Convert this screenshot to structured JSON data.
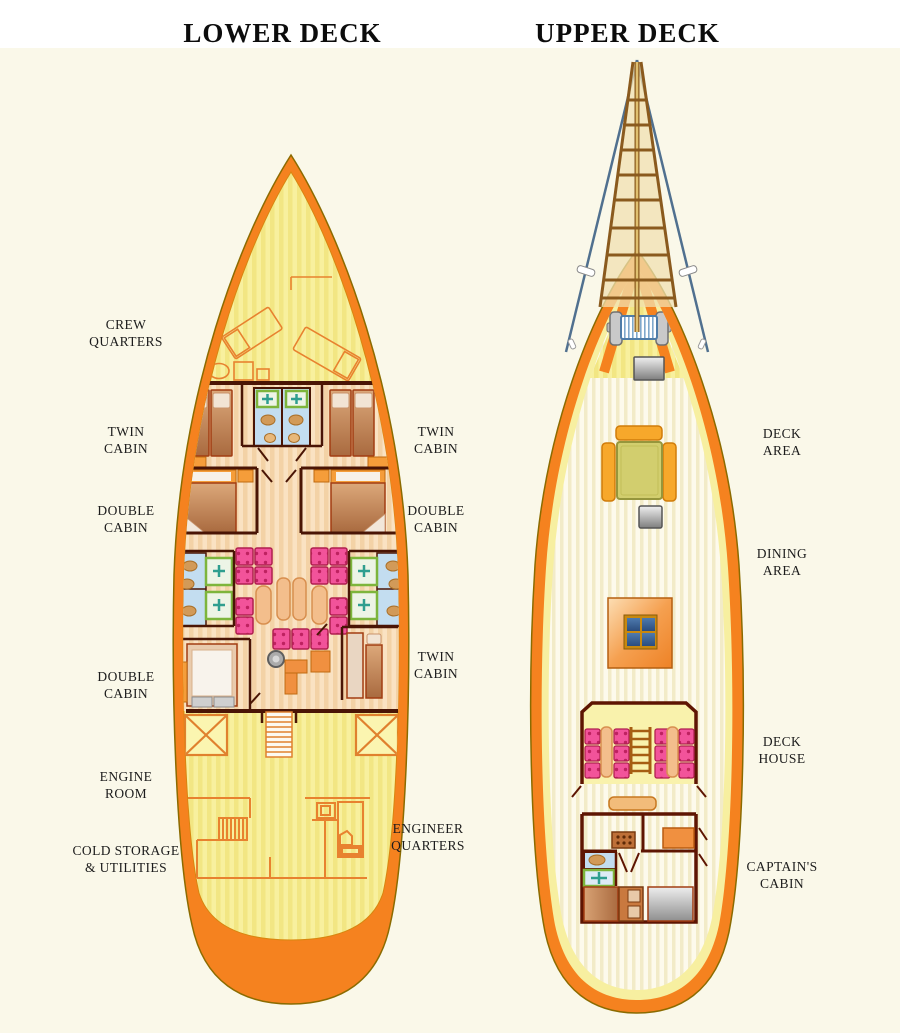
{
  "titles": {
    "lower": "LOWER DECK",
    "upper": "UPPER DECK"
  },
  "lower_deck": {
    "labels_left": [
      {
        "lines": [
          "CREW",
          "QUARTERS"
        ]
      },
      {
        "lines": [
          "TWIN",
          "CABIN"
        ]
      },
      {
        "lines": [
          "DOUBLE",
          "CABIN"
        ]
      },
      {
        "lines": [
          "DOUBLE",
          "CABIN"
        ]
      },
      {
        "lines": [
          "ENGINE",
          "ROOM"
        ]
      },
      {
        "lines": [
          "COLD STORAGE",
          "& UTILITIES"
        ]
      }
    ],
    "labels_right": [
      {
        "lines": [
          "TWIN",
          "CABIN"
        ]
      },
      {
        "lines": [
          "DOUBLE",
          "CABIN"
        ]
      },
      {
        "lines": [
          "TWIN",
          "CABIN"
        ]
      },
      {
        "lines": [
          "ENGINEER",
          "QUARTERS"
        ]
      }
    ]
  },
  "upper_deck": {
    "labels_right": [
      {
        "lines": [
          "DECK",
          "AREA"
        ]
      },
      {
        "lines": [
          "DINING",
          "AREA"
        ]
      },
      {
        "lines": [
          "DECK",
          "HOUSE"
        ]
      },
      {
        "lines": [
          "CAPTAIN'S",
          "CABIN"
        ]
      }
    ]
  },
  "features": {
    "upper": [
      "bowsprit-ladder",
      "rigging-stays",
      "anchor-windlass",
      "deck-hatch",
      "dining-table",
      "bench-seating",
      "skylight-window",
      "companionway-ladder",
      "galley-counter",
      "captain-bed",
      "berth",
      "bathroom"
    ],
    "lower": [
      "crew-beds",
      "twin-beds",
      "double-beds",
      "bathrooms",
      "salon-seating",
      "galley-table",
      "engine-hatches",
      "staircase",
      "storage-rooms"
    ]
  },
  "colors": {
    "hull_orange": "#F5821F",
    "deck_yellow": "#F8F09E",
    "cabin_floor": "#FAE2C2",
    "wall_dark": "#4A1505",
    "wood_outline": "#E8822F",
    "seat_pink": "#F2539A",
    "table_olive": "#D2CE6E",
    "bench_orange": "#F7A82B",
    "bath_blue": "#C3DDF0",
    "shower_green": "#7DB53C",
    "rigging_blue": "#50708F",
    "background": "#FAF8E9"
  }
}
